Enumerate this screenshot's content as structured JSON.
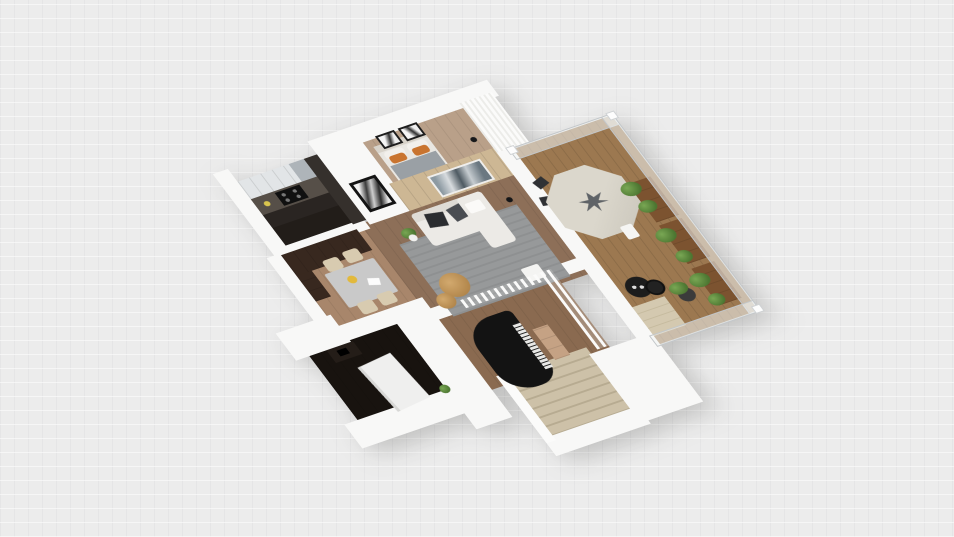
{
  "scene": {
    "type": "3d-floorplan-render",
    "view": "rotated isometric top view of an apartment, empty light-gray canvas background with faint grid",
    "rooms": [
      {
        "name": "bedroom",
        "objects": [
          "double-bed",
          "gray-blanket",
          "orange-pillows",
          "two-wall-art-frames",
          "floor-lamp",
          "louvered-wardrobe"
        ]
      },
      {
        "name": "kitchen",
        "objects": [
          "white-upper-cabinets",
          "tall-dark-cabinet",
          "counter",
          "stove",
          "dark-floor",
          "yellow-item"
        ]
      },
      {
        "name": "hallway",
        "objects": [
          "black-framed-picture"
        ]
      },
      {
        "name": "dining-room",
        "objects": [
          "gray-dining-table",
          "four-beige-chairs",
          "yellow-fruit-bowl",
          "white-tablet",
          "dark-brown-cabinet-wall"
        ]
      },
      {
        "name": "living-room",
        "objects": [
          "wood-accent-wall",
          "framed-landscape-art",
          "white-sofa-with-chaise",
          "dark-throw-pillows",
          "gray-area-rug",
          "large-jute-pouf",
          "small-jute-pouf",
          "white-coffee-box",
          "potted-plant",
          "black-floor-lamp"
        ]
      },
      {
        "name": "dark-bedroom",
        "objects": [
          "white-bed",
          "desk",
          "monitor",
          "desk-chair",
          "plant"
        ]
      },
      {
        "name": "piano-room",
        "objects": [
          "black-grand-piano",
          "piano-keyboard",
          "wooden-bench",
          "mezzanine-railing",
          "staircase-down"
        ]
      },
      {
        "name": "balcony",
        "objects": [
          "octagonal-patio-table",
          "umbrella-base-graphic",
          "dark-patio-chairs",
          "white-patio-chair",
          "three-wooden-planter-boxes",
          "green-plants",
          "black-bistro-table",
          "black-stool",
          "potted-plant",
          "beige-steps",
          "glass-railing"
        ]
      }
    ],
    "colors": {
      "bg": "#ececec",
      "wall": "#f8f8f7",
      "woodBedroom": "#b9a089",
      "woodLiving": "#8d6f58",
      "woodDining": "#a8866b",
      "woodPiano": "#8a6a50",
      "deck": "#9c7850",
      "accentWood": "#cdb794",
      "kitchenDark": "#221d19",
      "cabinetUpper": "#e2e5e7",
      "cabinetTall": "#35302c",
      "counter": "#564f48",
      "darkRoom": "#18130f",
      "brownCabinet": "#38281f",
      "rug": "#97999a",
      "sofa": "#eceae6",
      "pillowDark": "#2b2d30",
      "bedBlanket": "#9aa0a5",
      "pillowOrange": "#c9742f",
      "jute": "#c59a5f",
      "piano": "#131313",
      "stairs": "#cdc1a8",
      "stairsAlt": "#b7ab91",
      "table": "#c9c9c9",
      "octagon": "#dbd7cc",
      "umbrellaSplat": "#5f6367",
      "planter": "#7c5330",
      "plant": "#5d8a3c",
      "glass": "rgba(243,245,246,0.55)",
      "glassEdge": "#c2c6c9",
      "chairBeige": "#d8cbb0"
    }
  }
}
